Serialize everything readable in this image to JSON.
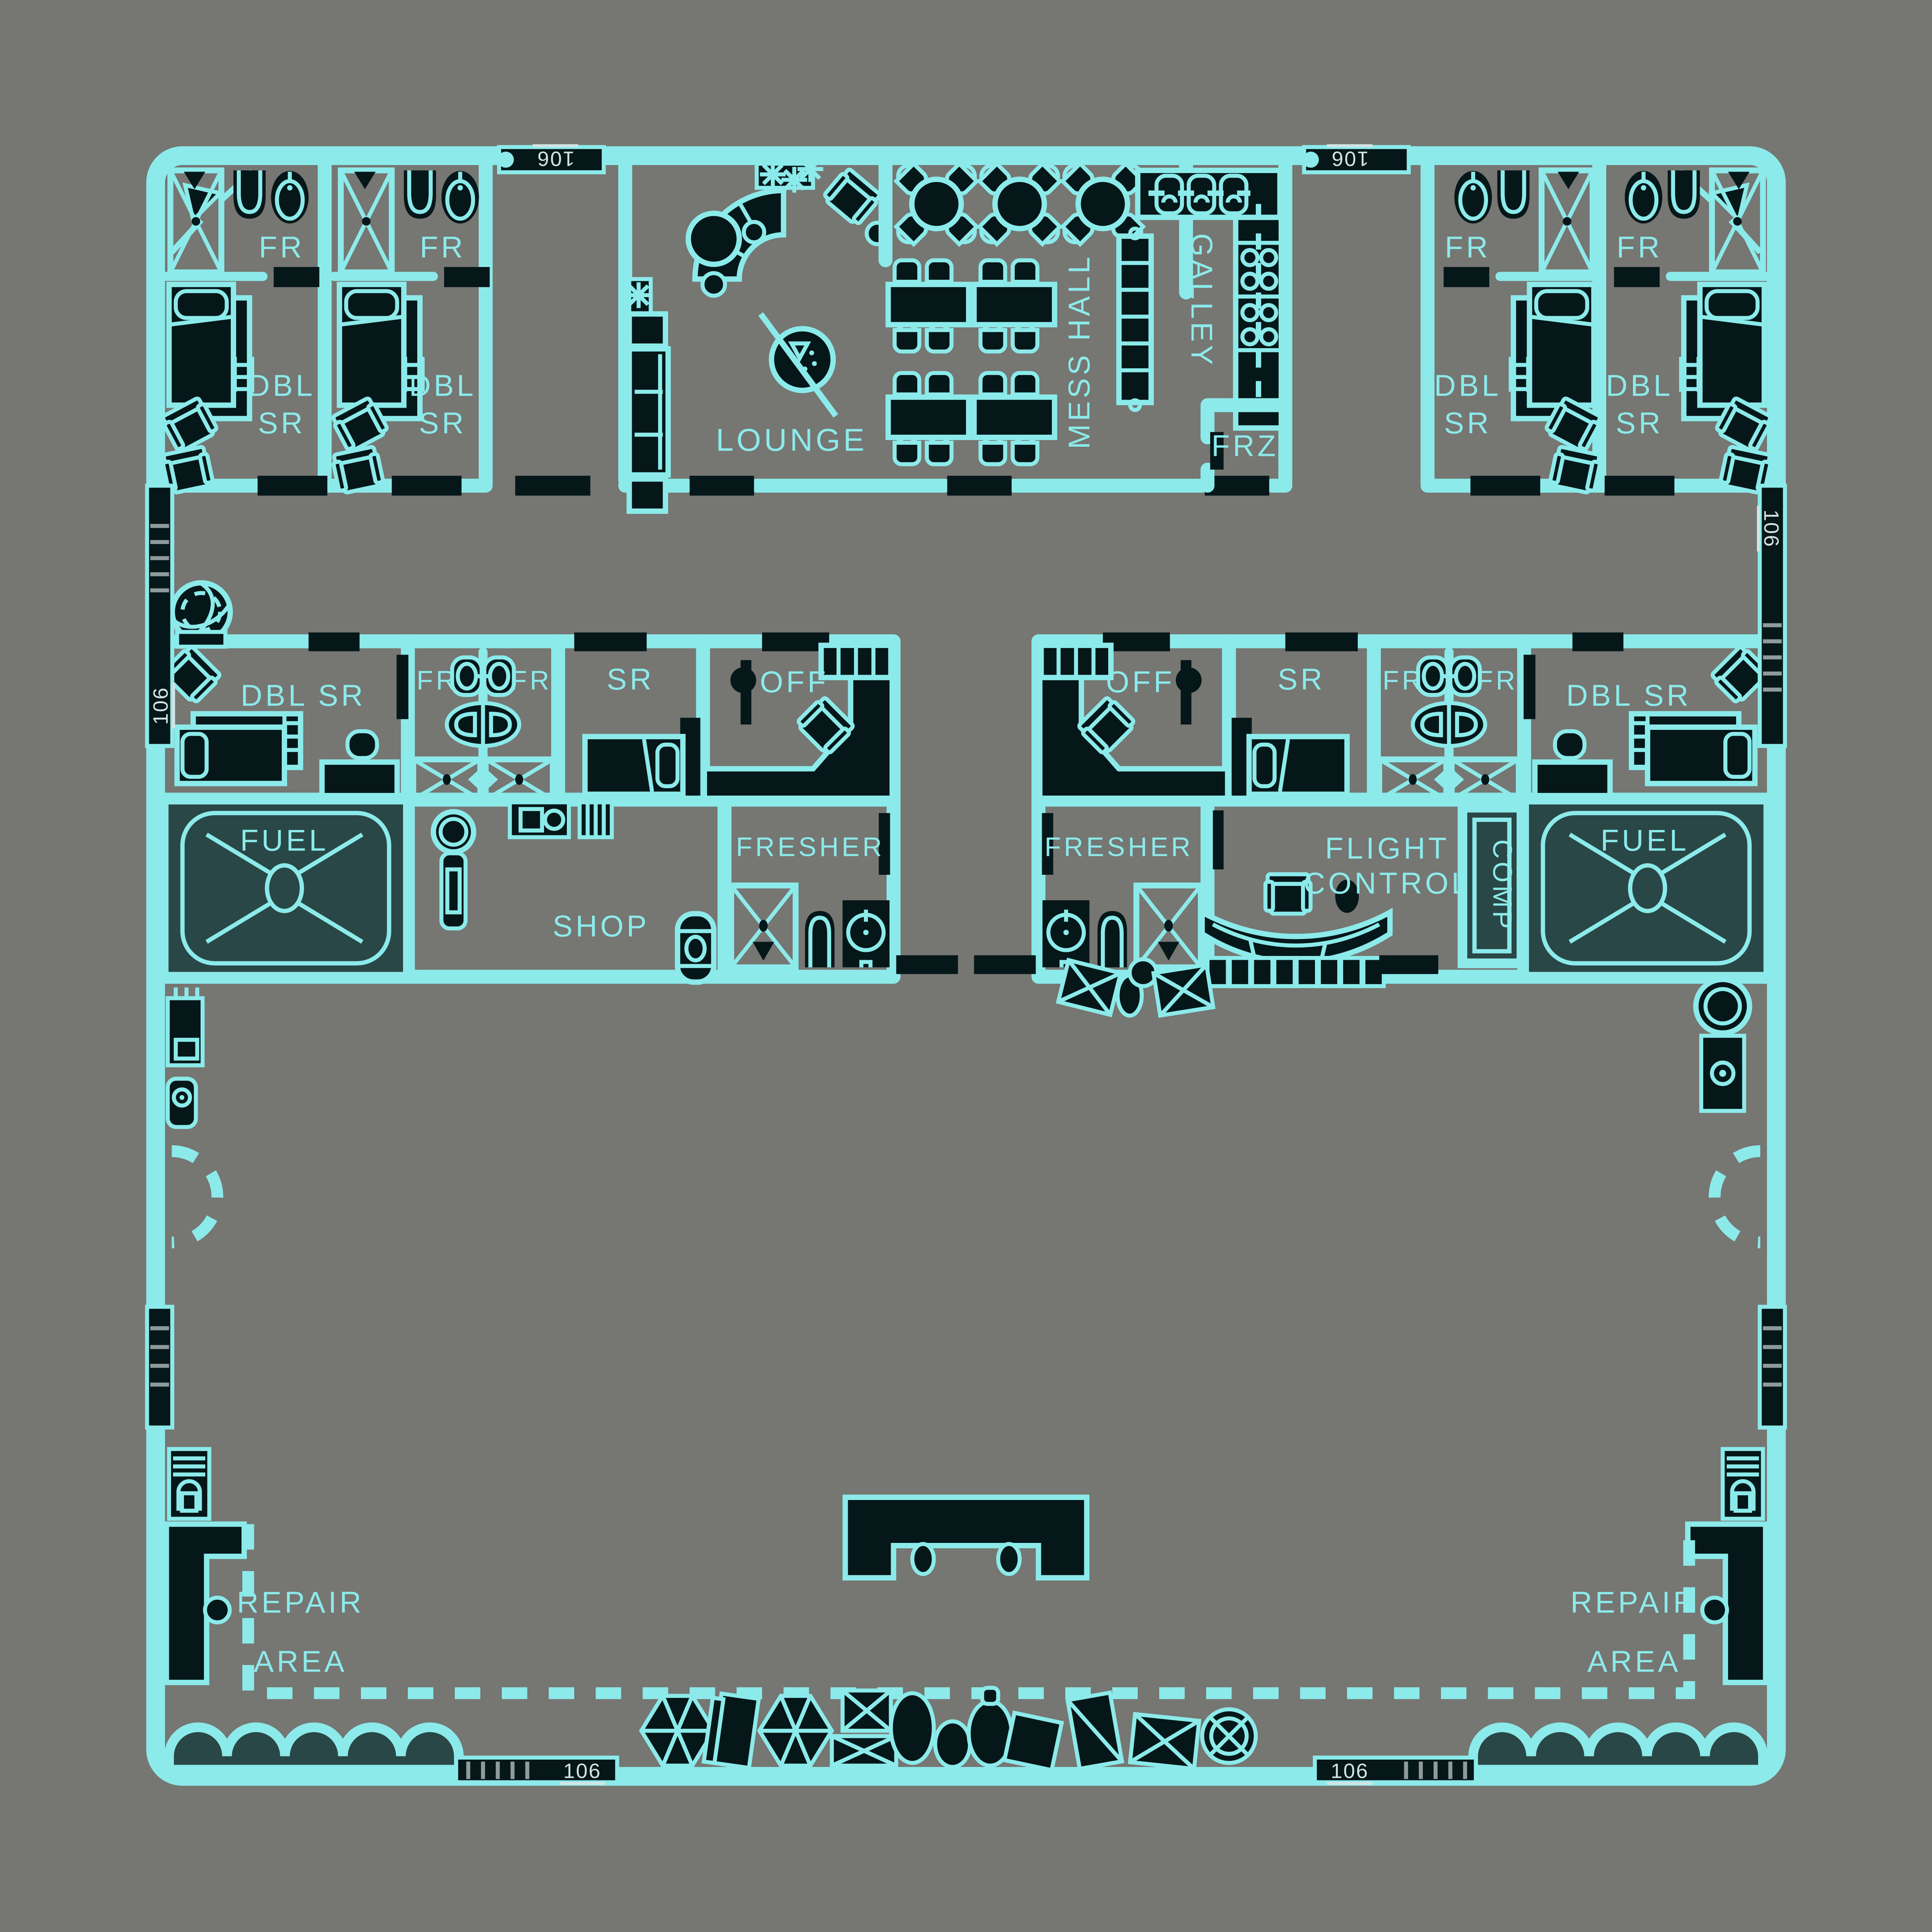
{
  "palette": {
    "background": "#767672",
    "line_cyan": "#8ceaea",
    "dark_fill": "#061719",
    "tank_teal": "#294746",
    "marker_text": "#d2e4e4",
    "ladder_rung": "#8f9a9a"
  },
  "plan": {
    "hatch_label": "106",
    "rooms": {
      "fresher_abbr": "FR",
      "double_line1": "DBL",
      "double_line2": "SR",
      "double_inline": "DBL SR",
      "stateroom": "SR",
      "office": "OFF",
      "lounge": "LOUNGE",
      "mess_hall": "MESS HALL",
      "galley": "GALLEY",
      "freezer": "FRZ",
      "fuel": "FUEL",
      "shop": "SHOP",
      "fresher": "FRESHER",
      "flight_line1": "FLIGHT",
      "flight_line2": "CONTROL",
      "computer": "COMP",
      "repair_line1": "REPAIR",
      "repair_line2": "AREA"
    },
    "room_list": [
      "DBL SR x6",
      "FR x8",
      "LOUNGE",
      "MESS HALL",
      "GALLEY",
      "FRZ",
      "SR x2",
      "OFF x2",
      "FUEL x2",
      "SHOP",
      "FRESHER x2",
      "FLIGHT CONTROL",
      "COMP",
      "REPAIR AREA x2"
    ]
  }
}
